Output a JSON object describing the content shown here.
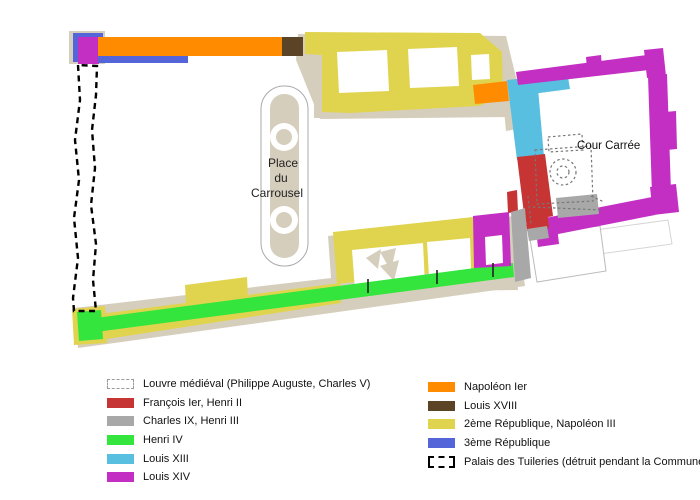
{
  "colors": {
    "francois": "#C73434",
    "charles": "#A8A8A8",
    "henri4": "#33E53C",
    "louis13": "#59BFE0",
    "louis14": "#C32FC3",
    "napoleon1": "#FF8C00",
    "louis18": "#5B4426",
    "rep2": "#E0D44E",
    "rep3": "#5365D8",
    "ground": "#D6CEBD",
    "medieval_outline": "#777777",
    "tuileries_outline": "#000000",
    "courtyard_outline": "#AAAAAA",
    "tick": "#222222"
  },
  "map": {
    "labels": {
      "carrousel_l1": "Place",
      "carrousel_l2": "du",
      "carrousel_l3": "Carrousel",
      "cour_carree": "Cour Carrée"
    }
  },
  "legend": {
    "left": [
      {
        "label": "Louvre médiéval (Philippe Auguste, Charles V)",
        "swatch": "dashed-light"
      },
      {
        "label": "François Ier, Henri II",
        "color": "#C73434"
      },
      {
        "label": "Charles IX, Henri III",
        "color": "#A8A8A8"
      },
      {
        "label": "Henri IV",
        "color": "#33E53C"
      },
      {
        "label": "Louis XIII",
        "color": "#59BFE0"
      },
      {
        "label": "Louis XIV",
        "color": "#C32FC3"
      }
    ],
    "right": [
      {
        "label": "Napoléon Ier",
        "color": "#FF8C00"
      },
      {
        "label": "Louis XVIII",
        "color": "#5B4426"
      },
      {
        "label": "2ème République, Napoléon III",
        "color": "#E0D44E"
      },
      {
        "label": "3ème République",
        "color": "#5365D8"
      },
      {
        "label": "Palais des Tuileries (détruit pendant la Commune)",
        "swatch": "dashed-black"
      }
    ]
  }
}
